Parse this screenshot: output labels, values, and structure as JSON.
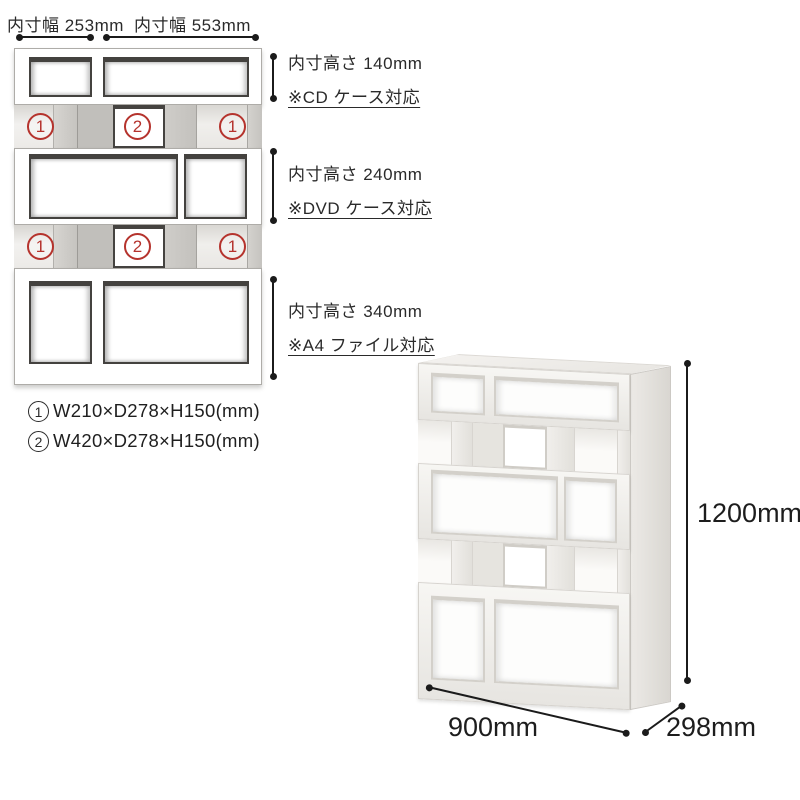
{
  "colors": {
    "accent_red": "#b5332d",
    "dimension_line": "#1b1b1b",
    "wood_light": "#dedcd8",
    "wood_mid": "#c6c4c0",
    "opening_shadow": "#44423f",
    "photo_white": "#f7f6f3",
    "photo_side": "#d9d6d1"
  },
  "front_diagram": {
    "width_dims": [
      {
        "label": "内寸幅 253mm"
      },
      {
        "label": "内寸幅 553mm"
      }
    ],
    "height_dims": [
      {
        "label": "内寸高さ 140mm",
        "note": "※CD ケース対応"
      },
      {
        "label": "内寸高さ 240mm",
        "note": "※DVD ケース対応"
      },
      {
        "label": "内寸高さ 340mm",
        "note": "※A4 ファイル対応"
      }
    ],
    "markers": {
      "row_a": [
        "1",
        "2",
        "1"
      ],
      "row_b": [
        "1",
        "2",
        "1"
      ]
    },
    "legend": [
      {
        "num": "1",
        "text": "W210×D278×H150(mm)"
      },
      {
        "num": "2",
        "text": "W420×D278×H150(mm)"
      }
    ]
  },
  "photo": {
    "height_label": "1200mm",
    "width_label": "900mm",
    "depth_label": "298mm"
  }
}
